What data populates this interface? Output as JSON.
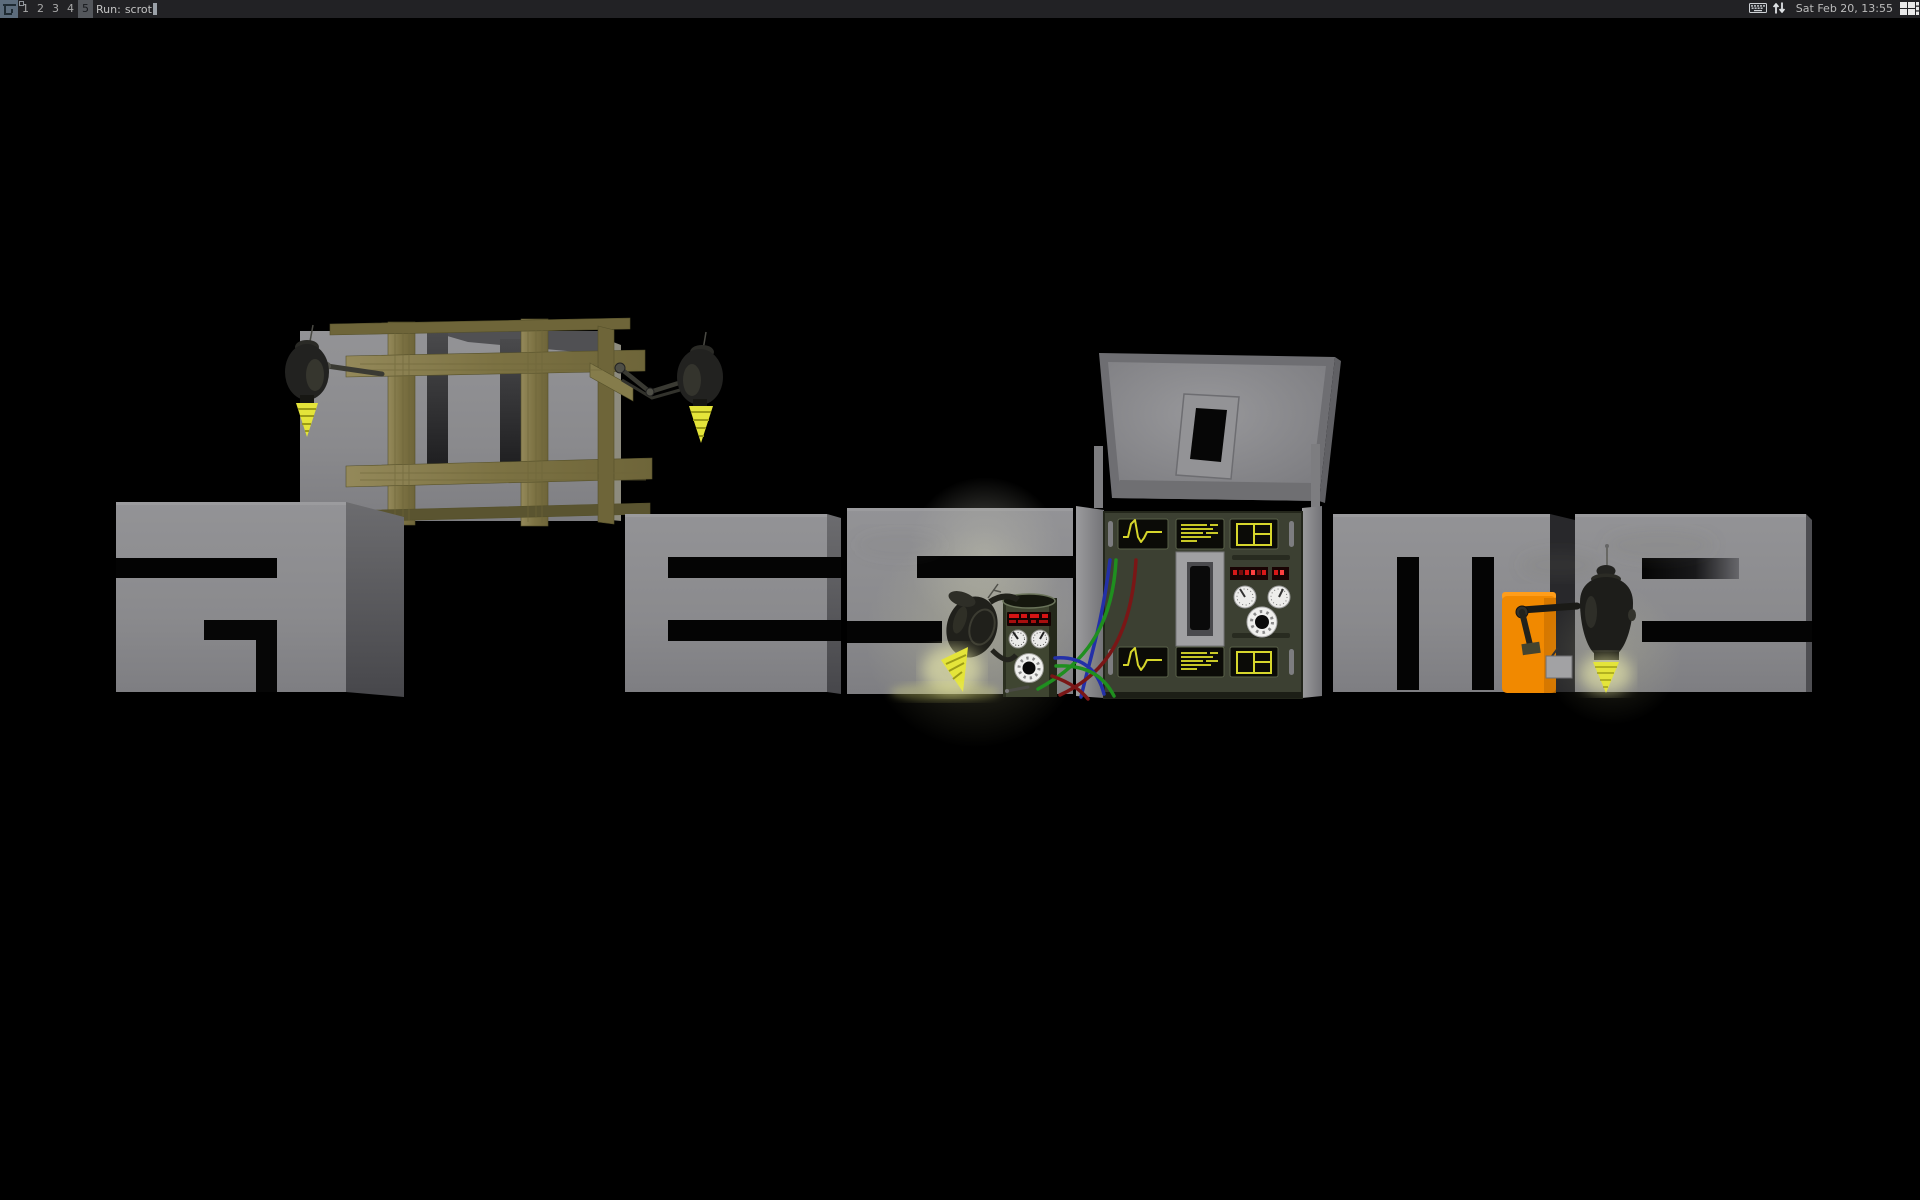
{
  "topbar": {
    "launcher_label": "awesome-menu",
    "tags": [
      "1",
      "2",
      "3",
      "4",
      "5"
    ],
    "selected_tag": "5",
    "tags_with_client": [
      "1"
    ],
    "prompt": {
      "label": "Run:",
      "command": "scrot"
    },
    "tray_icons": [
      "keyboard-icon",
      "arrows-updown-icon"
    ],
    "clock": "Sat Feb 20, 13:55",
    "layoutbox": "grid-layout-icon"
  },
  "wallpaper": {
    "word": "awesome",
    "letters": [
      "a",
      "w",
      "e",
      "s",
      "o",
      "m",
      "e"
    ],
    "alt_text": "awesome window manager wallpaper: gray 3D letters spelling awesome, the w delivered in a wooden crate by drone robots, the o a machine console with dials and oscilloscopes, welder robots with glowing drills"
  },
  "colors": {
    "bar_bg": "#222225",
    "bar_fg": "#a9a9a9",
    "tag_selected_bg": "#54575c",
    "tag_selected_fg": "#17191d",
    "prompt_fg": "#c3c3c3",
    "clock_fg": "#bcbcbc",
    "launcher_bg": "#5c6c7c",
    "letter_front": "#8e8e90",
    "letter_side": "#55555a",
    "wood": "#847a47",
    "drill_yellow": "#e4e43a",
    "robot_body": "#20201b",
    "machine_panel": "#3c4032",
    "screen_yellow": "#d6d62c",
    "led_red": "#d41414",
    "wire_red": "#7a1616",
    "wire_green": "#1f8f1f",
    "wire_blue": "#2a35c8",
    "orange": "#f18900",
    "background": "#000000"
  }
}
